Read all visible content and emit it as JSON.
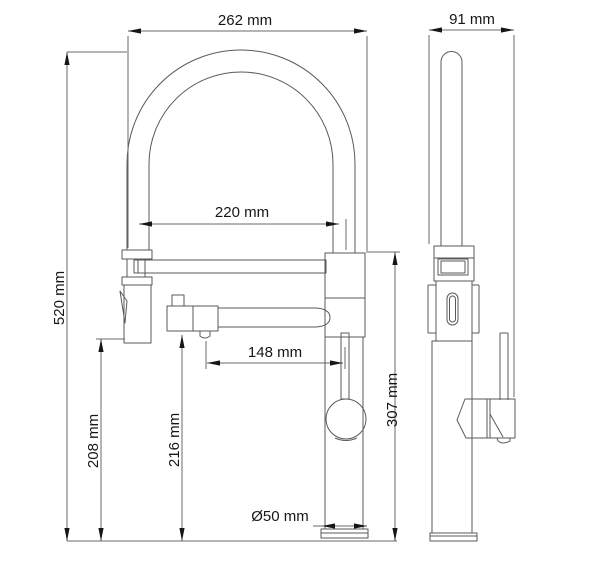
{
  "drawing": {
    "title": "faucet-dimension-drawing",
    "views": {
      "front": "front view",
      "side": "side view"
    },
    "dimensions": {
      "front_width": "262 mm",
      "side_width": "91 mm",
      "spout_reach": "220 mm",
      "filter_spout_reach": "148 mm",
      "base_diameter": "Ø50 mm",
      "total_height": "520 mm",
      "spray_outlet_height": "208 mm",
      "filter_outlet_height": "216 mm",
      "body_top_height": "307 mm"
    },
    "colors": {
      "line": "#5a5a5a",
      "heavy_line": "#3c3c3c",
      "dimension_line": "#6a6a6a",
      "dimension_text": "#161616",
      "background": "#ffffff"
    }
  }
}
